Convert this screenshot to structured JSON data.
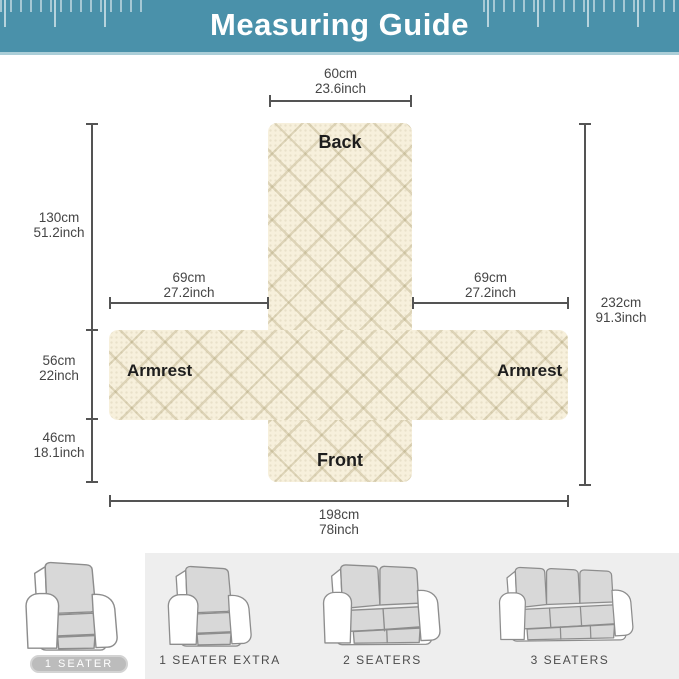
{
  "header": {
    "title": "Measuring Guide"
  },
  "diagram": {
    "pieces": {
      "back": "Back",
      "front": "Front",
      "armrest_left": "Armrest",
      "armrest_right": "Armrest"
    },
    "measurements": {
      "back_width": {
        "cm": "60cm",
        "inch": "23.6inch"
      },
      "back_height": {
        "cm": "130cm",
        "inch": "51.2inch"
      },
      "armrest_height": {
        "cm": "56cm",
        "inch": "22inch"
      },
      "front_height": {
        "cm": "46cm",
        "inch": "18.1inch"
      },
      "armrest_width_left": {
        "cm": "69cm",
        "inch": "27.2inch"
      },
      "armrest_width_right": {
        "cm": "69cm",
        "inch": "27.2inch"
      },
      "total_length": {
        "cm": "232cm",
        "inch": "91.3inch"
      },
      "total_width": {
        "cm": "198cm",
        "inch": "78inch"
      }
    }
  },
  "variants": {
    "items": [
      {
        "label": "1 SEATER",
        "selected": true
      },
      {
        "label": "1 SEATER EXTRA",
        "selected": false
      },
      {
        "label": "2 SEATERS",
        "selected": false
      },
      {
        "label": "3 SEATERS",
        "selected": false
      }
    ]
  },
  "colors": {
    "header_teal": "#4a91aa",
    "header_rule_light": "#abced8",
    "fabric_cream": "#f7f0dc",
    "measure_gray": "#545454",
    "panel_gray": "#eeeeee",
    "cover_gray": "#d8d8d8",
    "outline_gray": "#8d8d8d",
    "badge_gray": "#bcbcbc"
  }
}
